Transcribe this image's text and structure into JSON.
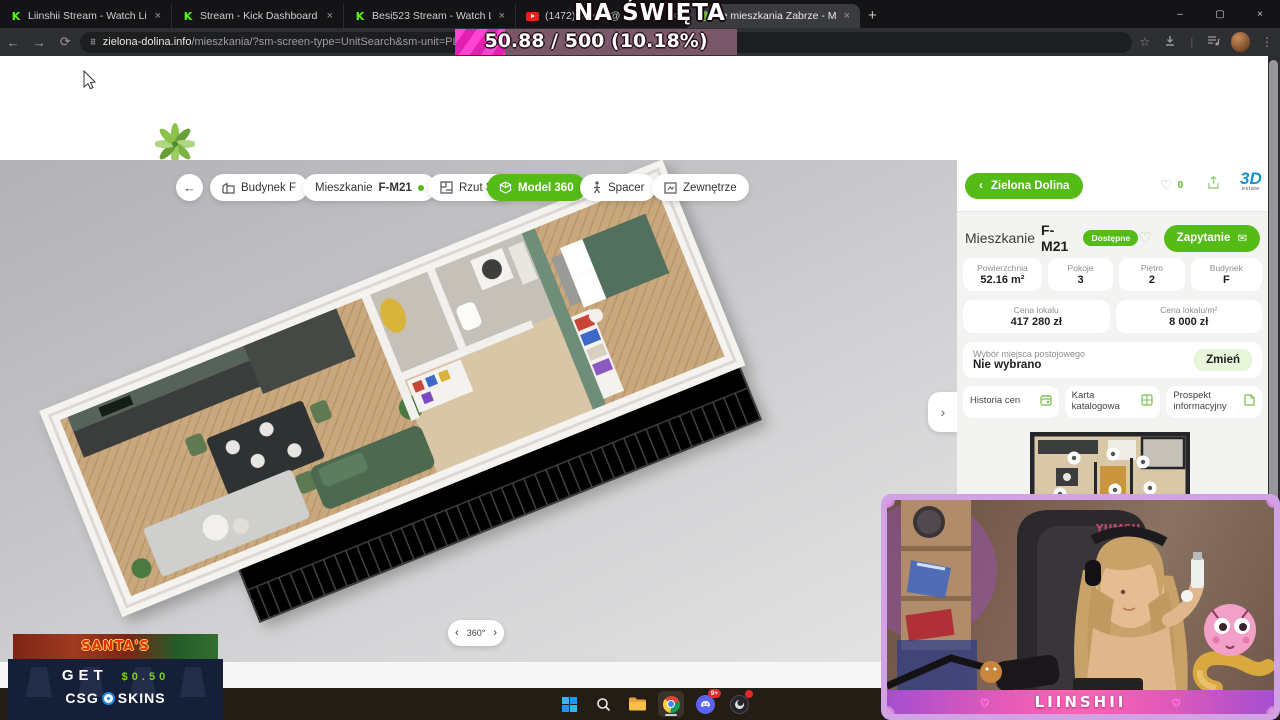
{
  "browser": {
    "tabs": [
      {
        "title": "Liinshii Stream - Watch Live on",
        "icon": "kick-icon"
      },
      {
        "title": "Stream - Kick Dashboard",
        "icon": "kick-icon"
      },
      {
        "title": "Besi523 Stream - Watch Live on",
        "icon": "kick-icon"
      },
      {
        "title": "(1472) Kizo x @",
        "icon": "youtube-icon"
      },
      {
        "title": "we mieszkania Zabrze - Mik",
        "icon": "site-icon"
      }
    ],
    "url": {
      "domain": "zielona-dolina.info",
      "path": "/mieszkania/?sm-screen-type=UnitSearch&sm-unit=PL-ZAB-0004_",
      "faint": "m-viewer-vie",
      "tail": "2&sm-media=Dollhouse"
    }
  },
  "goal_overlay": {
    "title": "NA ŚWIĘTA",
    "progress_text": "50.88 / 500 (10.18%)",
    "current": 50.88,
    "goal": 500,
    "percent": "10.18%"
  },
  "site": {
    "logo_text": "— Zielona Dolina —",
    "phone": "+48 663 773 773",
    "nav": [
      "O inwestycji",
      "Oferty specjalne",
      "Oferta",
      "Finansowanie",
      "Aktualności",
      "Kontakt",
      "Panel klienta"
    ],
    "social": {
      "linkedin": "in",
      "facebook": "f"
    }
  },
  "viewer": {
    "building": "Budynek F",
    "unit_prefix": "Mieszkanie",
    "unit_code": "F-M21",
    "tab_plan": "Rzut 3D",
    "tab_model": "Model 360",
    "tab_walk": "Spacer",
    "tab_exterior": "Zewnętrze",
    "rotate_label": "360°"
  },
  "panel": {
    "back_label": "Zielona Dolina",
    "fav_count": "0",
    "brand_top": "3D",
    "brand_sub": "estate",
    "unit_label": "Mieszkanie",
    "unit_code": "F-M21",
    "status": "Dostępne",
    "inquiry_label": "Zapytanie",
    "stats": [
      {
        "label": "Powierzchnia",
        "value": "52.16 m²"
      },
      {
        "label": "Pokoje",
        "value": "3"
      },
      {
        "label": "Piętro",
        "value": "2"
      },
      {
        "label": "Budynek",
        "value": "F"
      }
    ],
    "prices": [
      {
        "label": "Cena lokalu",
        "value": "417 280 zł"
      },
      {
        "label": "Cena lokalu/m²",
        "value": "8 000 zł"
      }
    ],
    "parking": {
      "label": "Wybór miejsca postojowego",
      "value": "Nie wybrano",
      "action": "Zmień"
    },
    "documents": [
      "Historia cen",
      "Karta katalogowa",
      "Prospekt informacyjny"
    ]
  },
  "ad": {
    "top": "SANTA'S",
    "get_label": "GET",
    "amount": "$0.50",
    "brand_left": "CSG",
    "brand_right": "SKINS"
  },
  "stream": {
    "name": "LIINSHII",
    "chair_brand": "YUMSU"
  },
  "taskbar": {
    "discord_badge": "9+"
  },
  "colors": {
    "accent_green": "#55bb17",
    "kick_green": "#53fc18",
    "overlay_pink": "#ff44d4"
  },
  "icons": {
    "close": "×",
    "plus": "+",
    "back": "←",
    "forward": "→",
    "reload": "⟳",
    "star": "☆",
    "menu": "⋮",
    "minimize": "–",
    "maximize": "▢",
    "heart": "♡",
    "heart_solid": "♥",
    "chev_left": "‹",
    "chev_right": "›",
    "envelope": "✉",
    "phone": "☎",
    "kick_k": "K",
    "tune": "⩩"
  }
}
